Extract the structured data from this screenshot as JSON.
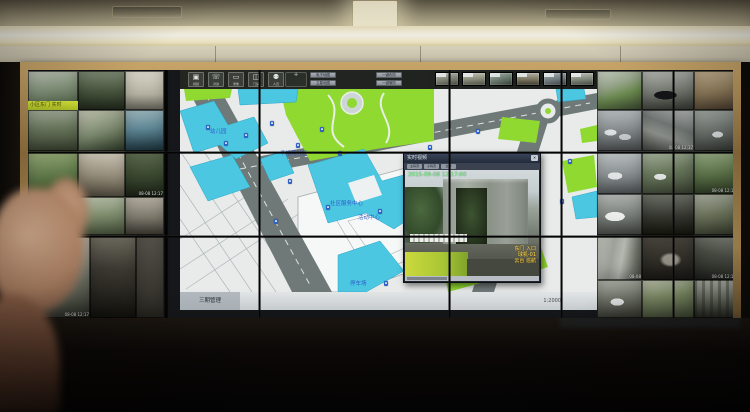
{
  "scene": {
    "description": "Photograph of a surveillance control-room video wall: left and right monitors show CCTV feeds, center monitors show a GIS community map with a live-video popup; ceiling cove light above, operator hand silhouette in foreground"
  },
  "colors": {
    "map_bg": "#e8ebea",
    "map_road": "#6f7977",
    "map_green": "#8fd930",
    "map_cyan": "#4cc7e2",
    "marker_blue": "#2e62c9",
    "label_blue": "#2749c0",
    "timestamp_green": "#8cf08c",
    "overlay_yellow": "#ffd94a",
    "frame_gold": "#a9854f",
    "banner_green": "#c8d832"
  },
  "wall": {
    "left_cameras": [
      {
        "x": 0,
        "y": 1,
        "w": 50,
        "h": 39,
        "bg": "linear-gradient(170deg,#c9cfc2,#8fa087 40%,#66785c 75%,#3c4a34)",
        "banner": "小区东门 实时"
      },
      {
        "x": 50,
        "y": 1,
        "w": 47,
        "h": 39,
        "bg": "linear-gradient(180deg,#7e8a74,#4a573f 50%,#232b1d)"
      },
      {
        "x": 97,
        "y": 1,
        "w": 39,
        "h": 39,
        "bg": "linear-gradient(180deg,#d8d5c8,#b5b2a2 60%,#6f6e62)"
      },
      {
        "x": 0,
        "y": 40,
        "w": 50,
        "h": 41,
        "bg": "linear-gradient(175deg,#aab3a0,#6d7a60 45%,#39422f)"
      },
      {
        "x": 50,
        "y": 40,
        "w": 47,
        "h": 41,
        "bg": "linear-gradient(160deg,#c4c6b4,#77856a 55%,#2f3a28)"
      },
      {
        "x": 97,
        "y": 40,
        "w": 39,
        "h": 41,
        "bg": "linear-gradient(175deg,#9fb6bd,#5f8795 45%,#32505c 80%,#1e333c)"
      },
      {
        "x": 0,
        "y": 81,
        "w": 50,
        "h": 46,
        "bg": "linear-gradient(170deg,#9fb37f,#5f7a48 55%,#324721)"
      },
      {
        "x": 50,
        "y": 81,
        "w": 47,
        "h": 46,
        "bg": "linear-gradient(185deg,#cfcabb,#978f7d 50%,#4f4a3c)"
      },
      {
        "x": 97,
        "y": 81,
        "w": 39,
        "h": 46,
        "bg": "linear-gradient(180deg,#5d6b4f,#36432c 60%,#1c2417)",
        "overlay": "08-08 12:17"
      },
      {
        "x": 0,
        "y": 127,
        "w": 50,
        "h": 38,
        "bg": "linear-gradient(180deg,#8d8a7c,#55524a 45%,#23211d)"
      },
      {
        "x": 50,
        "y": 127,
        "w": 47,
        "h": 38,
        "bg": "linear-gradient(175deg,#b7bfa9,#7d8a6b 50%,#46523a)"
      },
      {
        "x": 97,
        "y": 127,
        "w": 39,
        "h": 38,
        "bg": "linear-gradient(180deg,#b3aea0,#7c776b 55%,#3f3c34)"
      },
      {
        "x": 0,
        "y": 165,
        "w": 62,
        "h": 83,
        "bg": "radial-gradient(ellipse 16px 8px at 62% 36%, #e8e8e4 60%, rgba(0,0,0,0) 61%), linear-gradient(165deg,#c2c3b8,#8e9184 40%,#565a4e 75%,#2a2d26)",
        "overlay": "08-08 12:17"
      },
      {
        "x": 62,
        "y": 165,
        "w": 46,
        "h": 83,
        "bg": "linear-gradient(180deg,#6e6a5e,#3c3a32 40%,#15140f)"
      },
      {
        "x": 108,
        "y": 165,
        "w": 28,
        "h": 83,
        "bg": "linear-gradient(180deg,#55524a,#2b2a24)"
      }
    ],
    "right_cameras": [
      {
        "x": 569,
        "y": 1,
        "w": 45,
        "h": 39,
        "bg": "linear-gradient(160deg,#c8cfc2,#98a58c 35%,#6b8a4f 60%,#3e4a33)"
      },
      {
        "x": 614,
        "y": 1,
        "w": 52,
        "h": 39,
        "bg": "radial-gradient(ellipse 16px 6px at 45% 62%, #15161a 70%, rgba(0,0,0,0) 71%), linear-gradient(175deg,#b7bab4,#787d74 50%,#3a3d36)"
      },
      {
        "x": 666,
        "y": 1,
        "w": 43,
        "h": 39,
        "bg": "linear-gradient(170deg,#c8b694,#937f5e 50%,#4e4030)"
      },
      {
        "x": 569,
        "y": 40,
        "w": 45,
        "h": 41,
        "bg": "radial-gradient(ellipse 10px 5px at 30% 55%, #dfe2e2 60%, rgba(0,0,0,0) 61%), radial-gradient(ellipse 10px 5px at 62% 66%, #c8ccce 60%, rgba(0,0,0,0) 61%), linear-gradient(175deg,#b9bfc0,#83898b 50%,#4a4e4f)"
      },
      {
        "x": 614,
        "y": 40,
        "w": 52,
        "h": 41,
        "bg": "linear-gradient(200deg,#b5b9b8,#6f7573 40%,#8b8f8a 62%,#3f433e)",
        "overlay": "08-08 12:17"
      },
      {
        "x": 666,
        "y": 40,
        "w": 43,
        "h": 41,
        "bg": "radial-gradient(ellipse 9px 5px at 55% 60%, #d8dbdc 60%, rgba(0,0,0,0) 61%), linear-gradient(170deg,#aab0ac,#6e746f 50%,#383c38)"
      },
      {
        "x": 569,
        "y": 81,
        "w": 45,
        "h": 43,
        "bg": "radial-gradient(ellipse 12px 6px at 40% 58%, #e2e5e5 60%, rgba(0,0,0,0) 61%), linear-gradient(175deg,#c2c7c8,#8b9193 52%,#505455)"
      },
      {
        "x": 614,
        "y": 81,
        "w": 52,
        "h": 43,
        "bg": "radial-gradient(ellipse 10px 5px at 35% 60%, #dfe3e3 60%, rgba(0,0,0,0) 61%), linear-gradient(170deg,#a8b39e,#6b7a5e 45%,#3c4434)"
      },
      {
        "x": 666,
        "y": 81,
        "w": 43,
        "h": 43,
        "bg": "linear-gradient(175deg,#9db38a,#5d7549 55%,#2f3d26)",
        "overlay": "08-08 12:17"
      },
      {
        "x": 569,
        "y": 124,
        "w": 45,
        "h": 41,
        "bg": "radial-gradient(ellipse 15px 7px at 40% 55%, #eceeec 65%, rgba(0,0,0,0) 66%), linear-gradient(175deg,#b4b9b6,#7c817d 50%,#434642)"
      },
      {
        "x": 614,
        "y": 124,
        "w": 52,
        "h": 41,
        "bg": "linear-gradient(180deg,#6b6f66,#34362f 55%,#17180f)"
      },
      {
        "x": 666,
        "y": 124,
        "w": 43,
        "h": 41,
        "bg": "linear-gradient(170deg,#b0b5a6,#70785f 50%,#3a4030)"
      },
      {
        "x": 569,
        "y": 165,
        "w": 45,
        "h": 45,
        "bg": "linear-gradient(100deg,#c3c6be 0%,#9da19a 35%,#b5b8b0 55%,#6f736a 80%,#474a42 100%)",
        "overlay": "08-08"
      },
      {
        "x": 614,
        "y": 165,
        "w": 52,
        "h": 45,
        "bg": "radial-gradient(ellipse 18px 12px at 55% 55%, #9a958a 40%, rgba(0,0,0,0) 62%), linear-gradient(180deg,#4a473e,#1c1b16)"
      },
      {
        "x": 666,
        "y": 165,
        "w": 43,
        "h": 45,
        "bg": "linear-gradient(195deg,#8a8d83,#4e5148 45%,#20211c)",
        "overlay": "08-08 12:17"
      },
      {
        "x": 569,
        "y": 210,
        "w": 45,
        "h": 38,
        "bg": "radial-gradient(ellipse 11px 6px at 45% 58%, #e4e6e5 60%, rgba(0,0,0,0) 61%), linear-gradient(175deg,#a9aca2,#6f7268 50%,#3a3c34)"
      },
      {
        "x": 614,
        "y": 210,
        "w": 52,
        "h": 38,
        "bg": "linear-gradient(170deg,#b9c0aa,#7c8a64 45%,#45503a)"
      },
      {
        "x": 666,
        "y": 210,
        "w": 43,
        "h": 38,
        "bg": "repeating-linear-gradient(90deg, rgba(30,35,30,.35) 0 3px, rgba(0,0,0,0) 3px 8px), linear-gradient(180deg,#aeb2a6,#5f6356 60%,#2b2d26)"
      }
    ],
    "map_app": {
      "toolbar": {
        "buttons": [
          {
            "glyph": "▣",
            "label": "视频"
          },
          {
            "glyph": "☏",
            "label": "对讲"
          },
          {
            "glyph": "▭",
            "label": "录像"
          },
          {
            "glyph": "◫",
            "label": "门禁"
          },
          {
            "glyph": "⚉",
            "label": "人员"
          }
        ],
        "navpad_glyph": "✛",
        "mini_buttons": [
          "电子地图",
          "卫星地图"
        ],
        "chips": [
          "一键布防",
          "一键撤防"
        ]
      },
      "thumbs": [
        {
          "bg": "linear-gradient(170deg,#b9bfb4,#798072 55%,#3f453a)"
        },
        {
          "bg": "linear-gradient(175deg,#c3c4b6,#8b8d7c 50%,#4a4c40)"
        },
        {
          "bg": "linear-gradient(165deg,#a9b4ab,#66756a 55%,#333d35)"
        },
        {
          "bg": "linear-gradient(180deg,#b4b0a2,#77735f 55%,#3d3a2e)"
        },
        {
          "bg": "linear-gradient(170deg,#adb6b8,#6d7779 55%,#373e40)"
        },
        {
          "bg": "linear-gradient(175deg,#bcc0b6,#7e8377 55%,#42463c)"
        }
      ],
      "labels": [
        {
          "x": 100,
          "y": 62,
          "text": "千禧苑社区"
        },
        {
          "x": 30,
          "y": 40,
          "text": "幼儿园"
        },
        {
          "x": 150,
          "y": 112,
          "text": "社区服务中心"
        },
        {
          "x": 178,
          "y": 126,
          "text": "活动中心"
        },
        {
          "x": 170,
          "y": 192,
          "text": "停车场"
        }
      ],
      "markers": [
        {
          "x": 26,
          "y": 36
        },
        {
          "x": 44,
          "y": 52
        },
        {
          "x": 64,
          "y": 44
        },
        {
          "x": 90,
          "y": 32
        },
        {
          "x": 116,
          "y": 54
        },
        {
          "x": 140,
          "y": 38
        },
        {
          "x": 158,
          "y": 62
        },
        {
          "x": 108,
          "y": 90
        },
        {
          "x": 146,
          "y": 116
        },
        {
          "x": 94,
          "y": 130
        },
        {
          "x": 198,
          "y": 120
        },
        {
          "x": 248,
          "y": 56
        },
        {
          "x": 296,
          "y": 40
        },
        {
          "x": 380,
          "y": 110
        },
        {
          "x": 204,
          "y": 192
        },
        {
          "x": 388,
          "y": 70
        }
      ],
      "status": {
        "left": "三期管理",
        "right": "1:2000"
      },
      "popup": {
        "title": "实时视频",
        "close": "✕",
        "tags": [
          "主码流",
          "子码流",
          "全屏"
        ],
        "timestamp": "2015-09-08 12:17:00",
        "overlay_lines": [
          "东门 入口",
          "球机-01",
          "云台 巡航"
        ]
      }
    }
  }
}
